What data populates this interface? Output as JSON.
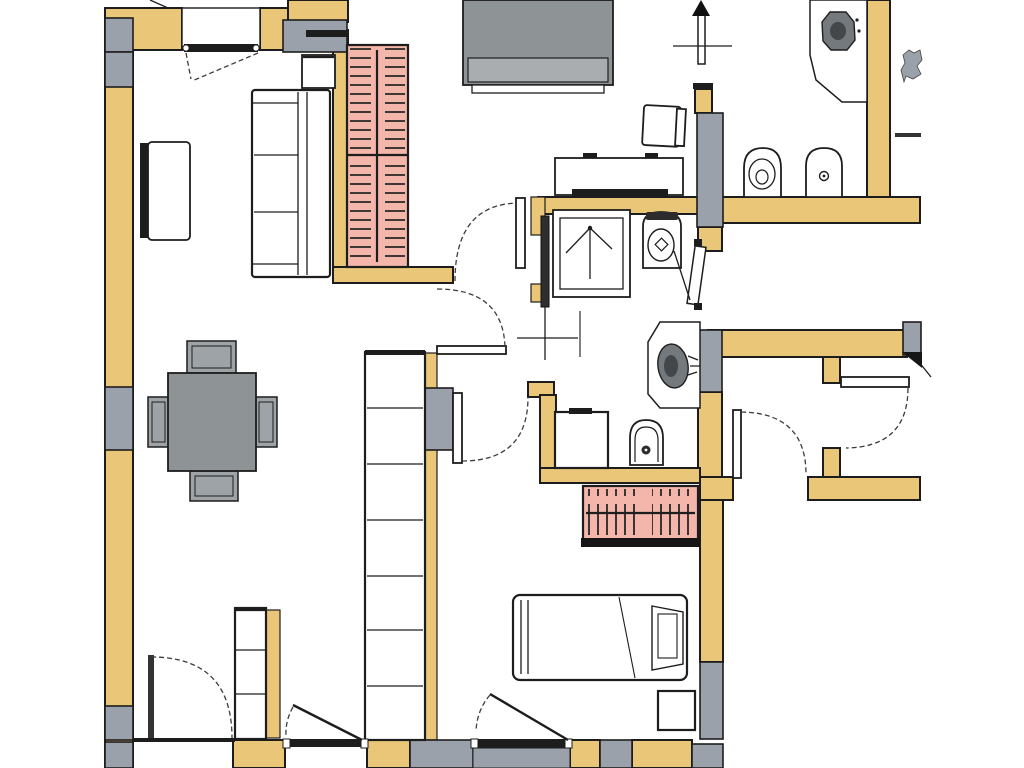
{
  "meta": {
    "kind": "scanned apartment floor plan, top-down view, no text labels visible",
    "orientation_marker": "north-arrow"
  },
  "colors": {
    "bg": "#ffffff",
    "wall": "#e9c678",
    "pier": "#9ba1aa",
    "furniture": "#8e9396",
    "furniture_band": "#a9adb0",
    "chair": "#9ea3a7",
    "wardrobe": "#f4b5ab",
    "ink": "#1d1d1d",
    "dash": "#3c3c3c",
    "sink": "#74797d",
    "sink_dark": "#43474a"
  },
  "legend": {
    "ochre_bands": "load-bearing walls",
    "gray_blocks": "masonry piers / lintels",
    "pink_hatched": "wardrobes with clothes hangers",
    "dashed_arcs": "door swings"
  },
  "inventory": {
    "living_area": [
      "sofa",
      "sideboard",
      "wall-cabinet",
      "wardrobe-hangers-left",
      "window"
    ],
    "study_room": [
      "large-gray-sofa",
      "desk",
      "desk-chair"
    ],
    "shower_room": [
      "shower",
      "toilet",
      "pocket-door-leaf",
      "axis-cross"
    ],
    "top_right_bathroom": [
      "corner-washbasin",
      "toilet",
      "bidet",
      "north-arrow",
      "wall-fixture"
    ],
    "small_bathroom": [
      "washbasin",
      "washing-machine",
      "bidet"
    ],
    "dining_area": [
      "dining-table",
      "dining-chair-top",
      "dining-chair-bottom",
      "dining-chair-left",
      "dining-chair-right"
    ],
    "bedroom": [
      "single-bed",
      "nightstand",
      "wardrobe-hangers-bedroom",
      "closet-column"
    ],
    "bottom_left_room": [
      "shelf-unit"
    ]
  },
  "counts": {
    "windows": 1,
    "door_swings": 9,
    "wardrobes": 2,
    "toilets": 2,
    "bidets": 2,
    "washbasins": 2
  }
}
